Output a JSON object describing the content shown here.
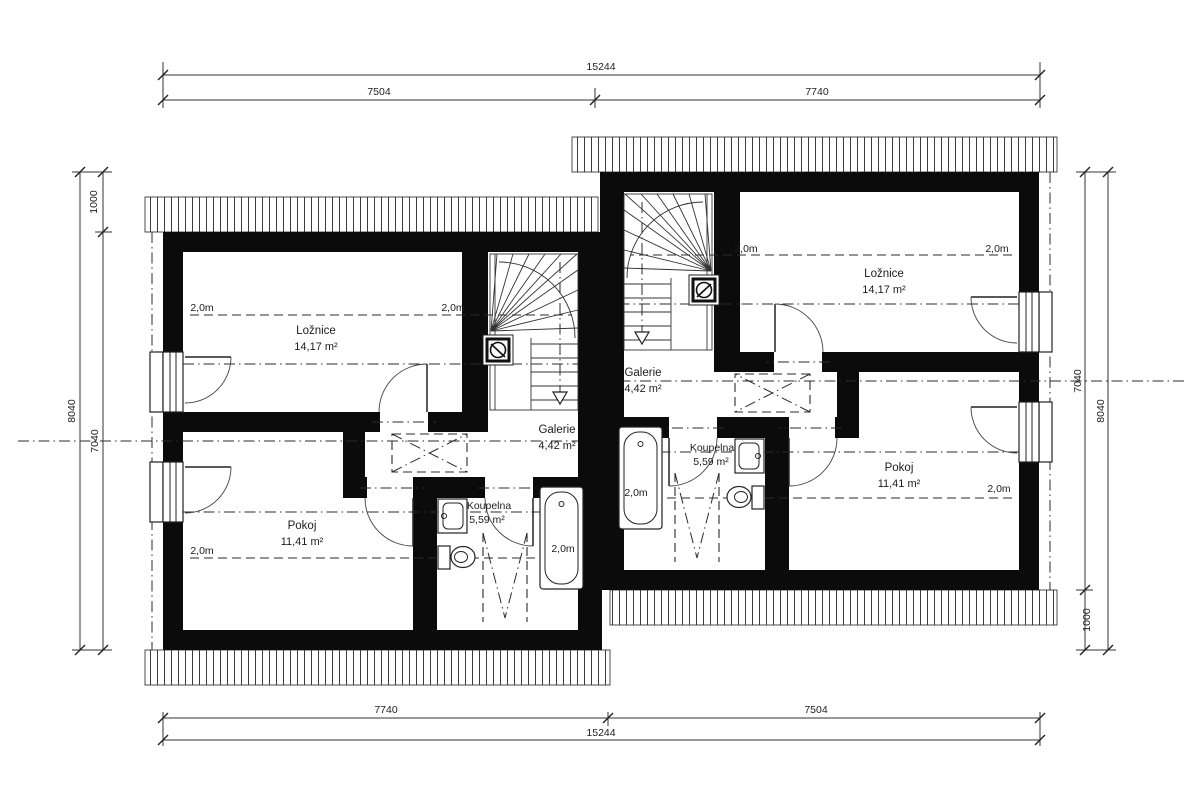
{
  "plan": {
    "headroom_label": "2,0m"
  },
  "dimensions": {
    "top": {
      "total": "15244",
      "segment_left": "7504",
      "segment_right": "7740"
    },
    "bottom": {
      "segment_left": "7740",
      "segment_right": "7504",
      "total": "15244"
    },
    "left_side": {
      "offset_top": "1000",
      "overall": "8040",
      "unit_height": "7040"
    },
    "right_side": {
      "unit_height": "7040",
      "overall": "8040",
      "offset_bottom": "1000"
    }
  },
  "units": {
    "left": {
      "loznice": {
        "name": "Ložnice",
        "area": "14,17 m²"
      },
      "galerie": {
        "name": "Galerie",
        "area": "4,42 m²"
      },
      "pokoj": {
        "name": "Pokoj",
        "area": "11,41 m²"
      },
      "koupelna": {
        "name": "Koupelna",
        "area": "5,59 m²"
      }
    },
    "right": {
      "loznice": {
        "name": "Ložnice",
        "area": "14,17 m²"
      },
      "galerie": {
        "name": "Galerie",
        "area": "4,42 m²"
      },
      "pokoj": {
        "name": "Pokoj",
        "area": "11,41 m²"
      },
      "koupelna": {
        "name": "Koupelna",
        "area": "5,59 m²"
      }
    }
  }
}
